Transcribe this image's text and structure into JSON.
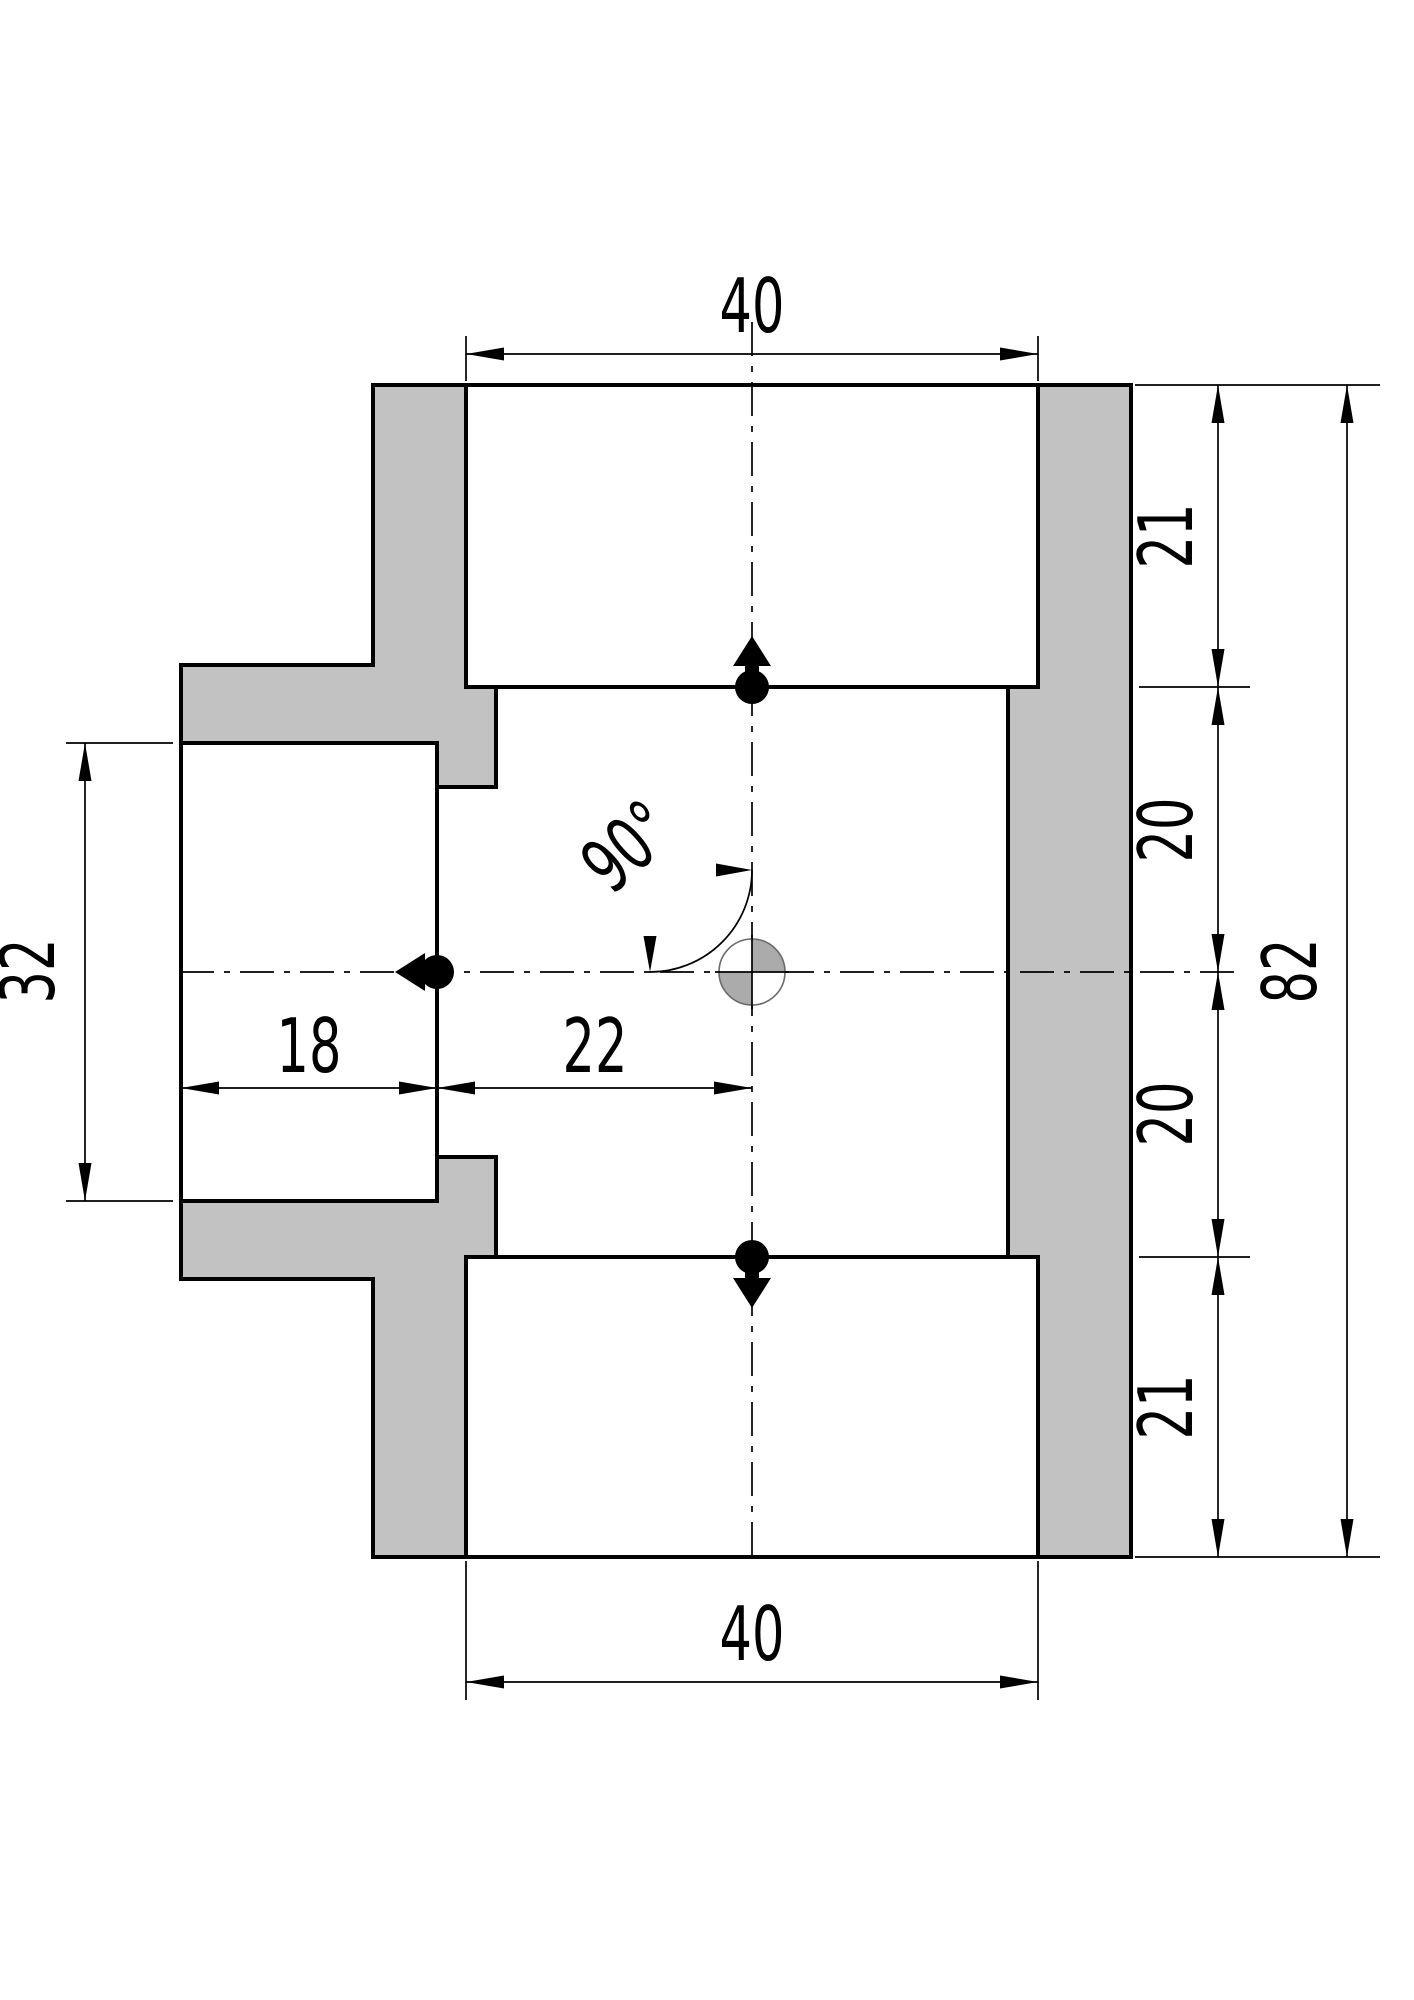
{
  "drawing": {
    "dimensions": {
      "top_width": "40",
      "bottom_width": "40",
      "right_segments": [
        "21",
        "20",
        "20",
        "21"
      ],
      "overall_height": "82",
      "left_bore_height": "32",
      "left_socket_depth": "18",
      "center_offset": "22",
      "branch_angle": "90°"
    },
    "colors": {
      "section_fill": "#c2c2c2",
      "outline": "#000000",
      "center_symbol_gray": "#ababab",
      "background": "#ffffff"
    }
  }
}
